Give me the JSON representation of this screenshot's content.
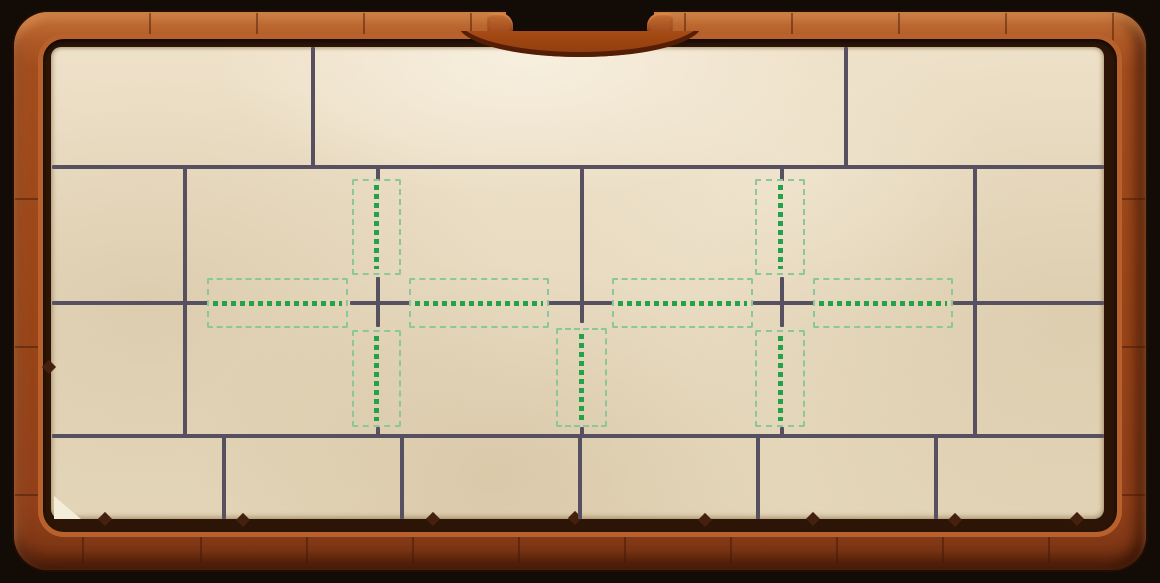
{
  "scene": {
    "name": "wooden-frame-puzzle-board",
    "description": "parchment puzzle board in carved wooden frame with crack lines and green placement hints"
  },
  "colors": {
    "background": "#130b06",
    "wood_light": "#c8763a",
    "wood_mid": "#a04c1e",
    "wood_dark": "#793413",
    "wood_lip": "#b9612c",
    "inner_gap": "#2c1507",
    "paper": "#e8dbc1",
    "paper_light": "#f3e9d6",
    "paper_shade": "#d9c7a6",
    "wall": "#565061",
    "hint_border": "#8cc79a",
    "hint_dot": "#23a24c"
  },
  "board": {
    "wall_thickness": 4,
    "walls_horizontal": [
      {
        "x": 52,
        "y": 167,
        "len": 1052
      },
      {
        "x": 52,
        "y": 303,
        "len": 157
      },
      {
        "x": 350,
        "y": 303,
        "len": 60
      },
      {
        "x": 548,
        "y": 303,
        "len": 64
      },
      {
        "x": 753,
        "y": 303,
        "len": 62
      },
      {
        "x": 953,
        "y": 303,
        "len": 151
      },
      {
        "x": 52,
        "y": 436,
        "len": 1052
      }
    ],
    "walls_vertical": [
      {
        "x": 313,
        "y": 47,
        "len": 122
      },
      {
        "x": 846,
        "y": 47,
        "len": 122
      },
      {
        "x": 185,
        "y": 167,
        "len": 271
      },
      {
        "x": 378,
        "y": 167,
        "len": 14
      },
      {
        "x": 378,
        "y": 277,
        "len": 50
      },
      {
        "x": 378,
        "y": 427,
        "len": 11
      },
      {
        "x": 582,
        "y": 167,
        "len": 156
      },
      {
        "x": 582,
        "y": 427,
        "len": 11
      },
      {
        "x": 782,
        "y": 167,
        "len": 14
      },
      {
        "x": 782,
        "y": 277,
        "len": 50
      },
      {
        "x": 782,
        "y": 427,
        "len": 11
      },
      {
        "x": 975,
        "y": 167,
        "len": 271
      },
      {
        "x": 224,
        "y": 436,
        "len": 83
      },
      {
        "x": 402,
        "y": 436,
        "len": 83
      },
      {
        "x": 580,
        "y": 436,
        "len": 83
      },
      {
        "x": 758,
        "y": 436,
        "len": 83
      },
      {
        "x": 936,
        "y": 436,
        "len": 83
      }
    ],
    "hint_slots": [
      {
        "id": "cross1-top-slot",
        "orientation": "vertical",
        "x": 352,
        "y": 179,
        "w": 49,
        "h": 96
      },
      {
        "id": "cross1-bottom-slot",
        "orientation": "vertical",
        "x": 352,
        "y": 330,
        "w": 49,
        "h": 97
      },
      {
        "id": "cross1-left-slot",
        "orientation": "horizontal",
        "x": 207,
        "y": 278,
        "w": 141,
        "h": 50
      },
      {
        "id": "cross1-right-slot",
        "orientation": "horizontal",
        "x": 409,
        "y": 278,
        "w": 140,
        "h": 50
      },
      {
        "id": "middle-bottom-slot",
        "orientation": "vertical",
        "x": 556,
        "y": 328,
        "w": 51,
        "h": 99
      },
      {
        "id": "cross2-top-slot",
        "orientation": "vertical",
        "x": 755,
        "y": 179,
        "w": 50,
        "h": 96
      },
      {
        "id": "cross2-bottom-slot",
        "orientation": "vertical",
        "x": 755,
        "y": 330,
        "w": 50,
        "h": 97
      },
      {
        "id": "cross2-left-slot",
        "orientation": "horizontal",
        "x": 612,
        "y": 278,
        "w": 141,
        "h": 50
      },
      {
        "id": "cross2-right-slot",
        "orientation": "horizontal",
        "x": 813,
        "y": 278,
        "w": 140,
        "h": 50
      }
    ]
  }
}
